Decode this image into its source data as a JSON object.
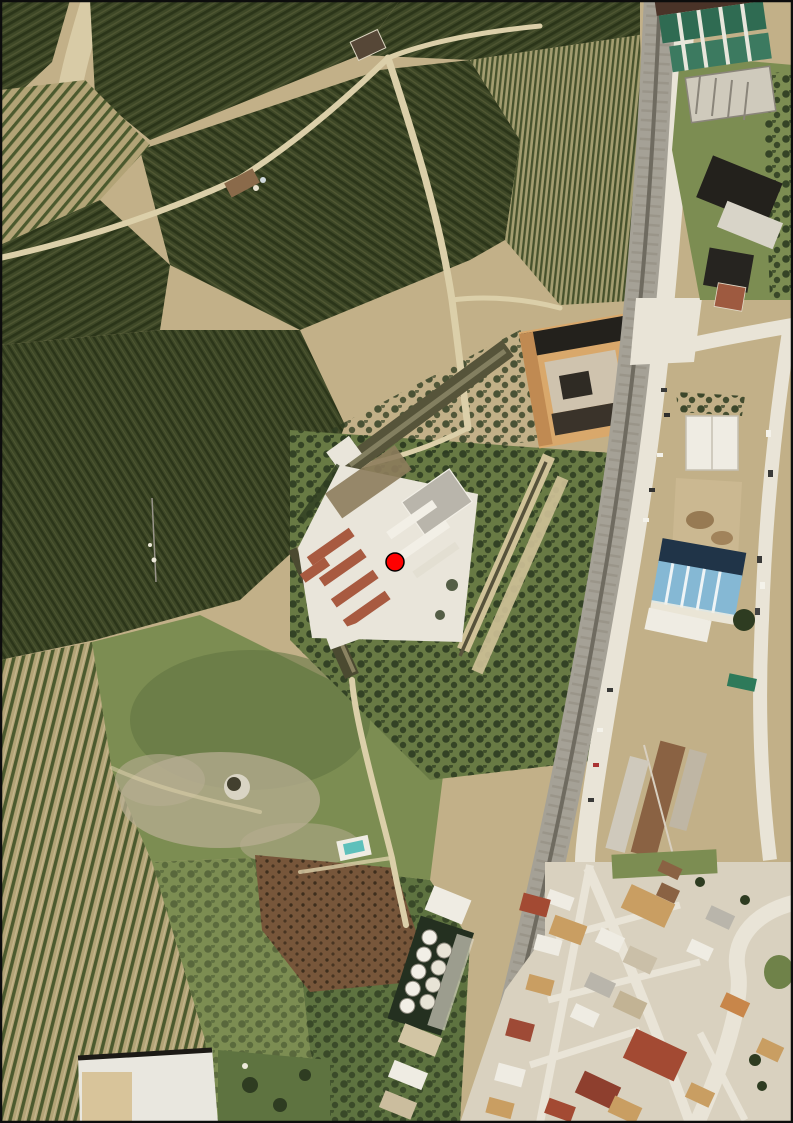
{
  "map": {
    "kind": "aerial-orthophoto",
    "marker": {
      "x": 395,
      "y": 562,
      "r": 9,
      "color": "#ff0000",
      "outline": "#000000",
      "outline_width": 1.5
    },
    "border_color": "#0d0d0d",
    "features": [
      "orchard-fields",
      "dirt-tracks",
      "monastery-compound",
      "courtyard-buildings",
      "perimeter-wings",
      "meadow",
      "round-cistern",
      "plowed-field",
      "scrubland",
      "railway-line",
      "main-road",
      "industrial-green-roof",
      "blue-roof-warehouse",
      "grain-silos",
      "village-houses",
      "roundabout",
      "farm-shed",
      "swimming-pool",
      "location-marker"
    ]
  },
  "palette": {
    "soil": "#c2b088",
    "soil_light": "#d8cba6",
    "path": "#dbcfa9",
    "orchard_dark": "#3e4827",
    "orchard_stripe": "#2b3519",
    "orchard_glint": "#6e7147",
    "orchard_young_base": "#b2a376",
    "orchard_young_row": "#4c5a2e",
    "orchard_fine_base": "#a39d70",
    "orchard_fine_row": "#47522c",
    "scrub_green": "#687a44",
    "tree_dark": "#2e3c21",
    "meadow": "#7c8d52",
    "meadow_dark": "#5e7340",
    "rock": "#b7ae92",
    "field_brown": "#77563a",
    "rail": "#a5a196",
    "rail_dark": "#6f6b60",
    "road": "#e9e4d7",
    "urban_base": "#d9d1bf",
    "roof_white": "#efece3",
    "roof_gray": "#b9b5ab",
    "roof_tan": "#c99e62",
    "roof_brown": "#8a6243",
    "roof_red": "#a34a33",
    "roof_dark": "#23211c",
    "roof_green": "#2f6b52",
    "roof_blue_light": "#85b8d4",
    "roof_blue_dark": "#203448",
    "wall_olive": "#56543a",
    "wing_tan": "#d0c298",
    "compound_white": "#e9e5da",
    "courtyard_dirt": "#8d7c5c",
    "terracotta": "#a85a40",
    "water": "#5ec0bb"
  }
}
